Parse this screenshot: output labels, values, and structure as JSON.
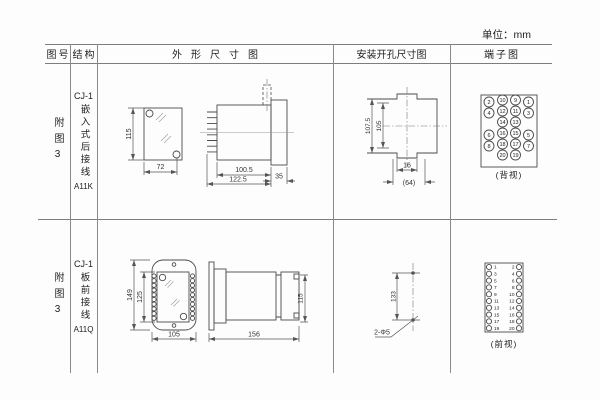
{
  "unit_label": "单位：mm",
  "headers": {
    "fig_no": "图号",
    "structure": "结构",
    "outline": "外形尺寸图",
    "install": "安装开孔尺寸图",
    "terminal": "端子图"
  },
  "r1": {
    "fig_no": "附图3",
    "model": "CJ-1",
    "mount": "嵌入式后接线",
    "code": "A11K",
    "d_height": "115",
    "d_width": "72",
    "d_body": "100.5",
    "d_total": "122.5",
    "d_flange": "35",
    "i_outer_h": "107.5",
    "i_inner_h": "105",
    "i_notch": "16",
    "i_width": "(64)",
    "t_label": "(背视)"
  },
  "r2": {
    "fig_no": "附图3",
    "model": "CJ-1",
    "mount": "板前接线",
    "code": "A11Q",
    "d_outer_h": "149",
    "d_inner_h": "125",
    "d_width": "105",
    "d_total": "156",
    "d_height": "115",
    "i_spacing": "133",
    "i_holes": "2-Φ5",
    "t_label": "(前视)"
  },
  "terminals_back": [
    {
      "n": "2",
      "c": 0,
      "r": 0
    },
    {
      "n": "10",
      "c": 1,
      "r": 0
    },
    {
      "n": "9",
      "c": 2,
      "r": 0
    },
    {
      "n": "1",
      "c": 3,
      "r": 0
    },
    {
      "n": "4",
      "c": 0,
      "r": 1
    },
    {
      "n": "12",
      "c": 1,
      "r": 1
    },
    {
      "n": "11",
      "c": 2,
      "r": 1
    },
    {
      "n": "3",
      "c": 3,
      "r": 1
    },
    {
      "n": "14",
      "c": 1,
      "r": 2
    },
    {
      "n": "13",
      "c": 2,
      "r": 2
    },
    {
      "n": "6",
      "c": 0,
      "r": 3
    },
    {
      "n": "16",
      "c": 1,
      "r": 3
    },
    {
      "n": "15",
      "c": 2,
      "r": 3
    },
    {
      "n": "5",
      "c": 3,
      "r": 3
    },
    {
      "n": "8",
      "c": 0,
      "r": 4
    },
    {
      "n": "18",
      "c": 1,
      "r": 4
    },
    {
      "n": "17",
      "c": 2,
      "r": 4
    },
    {
      "n": "7",
      "c": 3,
      "r": 4
    },
    {
      "n": "20",
      "c": 1,
      "r": 5
    },
    {
      "n": "19",
      "c": 2,
      "r": 5
    }
  ],
  "terminals_front": {
    "left": [
      "1",
      "3",
      "5",
      "7",
      "9",
      "11",
      "13",
      "15",
      "17",
      "19"
    ],
    "right": [
      "2",
      "4",
      "6",
      "8",
      "10",
      "12",
      "14",
      "16",
      "18",
      "20"
    ]
  }
}
